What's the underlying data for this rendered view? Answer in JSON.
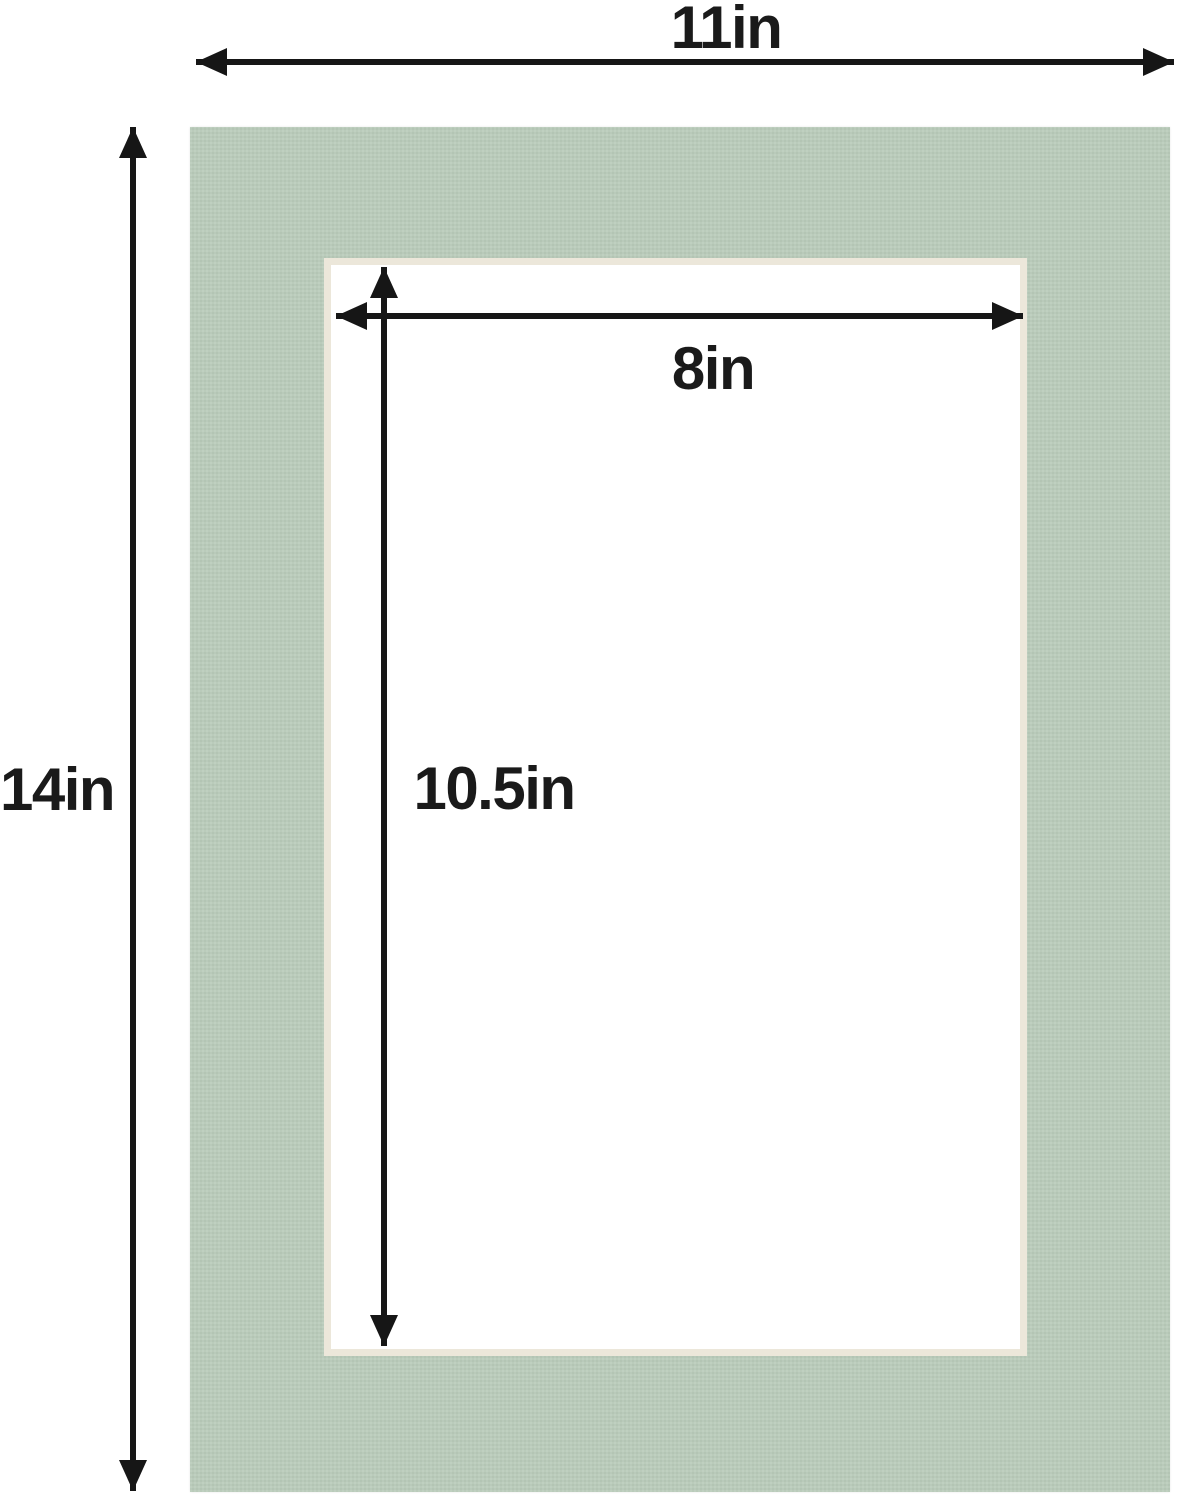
{
  "labels": {
    "outer_width": "11in",
    "outer_height": "14in",
    "opening_width": "8in",
    "opening_height": "10.5in"
  },
  "colors": {
    "background": "#ffffff",
    "mat": "#b9cbba",
    "bevel": "#ece7da",
    "arrow": "#161616",
    "label_text": "#1a1a1a"
  }
}
